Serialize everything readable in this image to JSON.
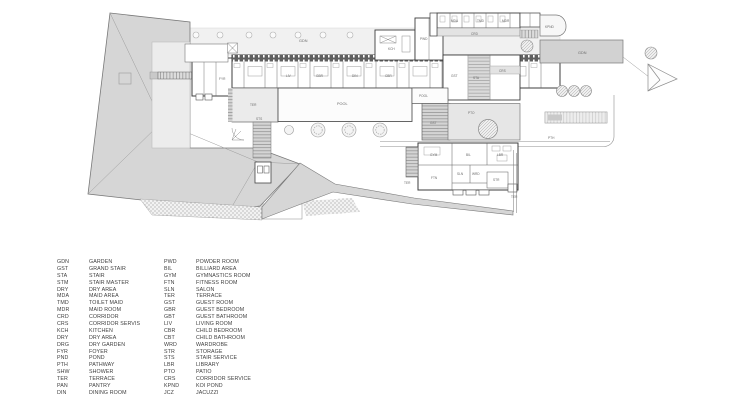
{
  "title": "residence-site-plan",
  "colors": {
    "wall": "#3d3d3d",
    "thin": "#8a8a8a",
    "roof": "#d6d6d6",
    "court": "#ececec",
    "strip": "#f1f1f1",
    "stair": "#d2d2d2",
    "patio": "#e6e6e6",
    "gdn": "#d2d2d2",
    "plantext": "#6b6b6b",
    "legendtext": "#3f3f3f"
  },
  "plan": {
    "labels": [
      {
        "t": "GDN",
        "x": 299,
        "y": 42,
        "s": "m"
      },
      {
        "t": "GDN",
        "x": 578,
        "y": 54,
        "s": "m"
      },
      {
        "t": "POOL",
        "x": 337,
        "y": 105,
        "s": "m"
      },
      {
        "t": "POOL",
        "x": 419,
        "y": 97,
        "s": "s"
      },
      {
        "t": "PTO",
        "x": 468,
        "y": 114,
        "s": "s"
      },
      {
        "t": "TER",
        "x": 250,
        "y": 106,
        "s": "s"
      },
      {
        "t": "GST",
        "x": 430,
        "y": 124,
        "s": "s"
      },
      {
        "t": "PTH",
        "x": 548,
        "y": 139,
        "s": "s"
      },
      {
        "t": "KPND",
        "x": 545,
        "y": 28,
        "s": "s"
      },
      {
        "t": "CRD",
        "x": 471,
        "y": 35,
        "s": "s"
      },
      {
        "t": "KCH",
        "x": 388,
        "y": 50,
        "s": "s"
      },
      {
        "t": "PWD",
        "x": 420,
        "y": 40,
        "s": "s"
      },
      {
        "t": "FYR",
        "x": 219,
        "y": 80,
        "s": "s"
      },
      {
        "t": "LIV",
        "x": 286,
        "y": 77,
        "s": "s"
      },
      {
        "t": "DIN",
        "x": 352,
        "y": 77,
        "s": "s"
      },
      {
        "t": "GBR",
        "x": 316,
        "y": 77,
        "s": "s"
      },
      {
        "t": "CBR",
        "x": 385,
        "y": 77,
        "s": "s"
      },
      {
        "t": "GST",
        "x": 451,
        "y": 77,
        "s": "s"
      },
      {
        "t": "GYM",
        "x": 430,
        "y": 156,
        "s": "s"
      },
      {
        "t": "BIL",
        "x": 466,
        "y": 156,
        "s": "s"
      },
      {
        "t": "LBR",
        "x": 497,
        "y": 156,
        "s": "s"
      },
      {
        "t": "FTN",
        "x": 431,
        "y": 179,
        "s": "s"
      },
      {
        "t": "SLN",
        "x": 457,
        "y": 175,
        "s": "s"
      },
      {
        "t": "WRD",
        "x": 472,
        "y": 175,
        "s": "s"
      },
      {
        "t": "STR",
        "x": 493,
        "y": 181,
        "s": "s"
      },
      {
        "t": "TER",
        "x": 404,
        "y": 184,
        "s": "s"
      },
      {
        "t": "TER",
        "x": 511,
        "y": 198,
        "s": "s"
      },
      {
        "t": "STS",
        "x": 256,
        "y": 120,
        "s": "s"
      },
      {
        "t": "STA",
        "x": 473,
        "y": 79,
        "s": "s"
      },
      {
        "t": "CRS",
        "x": 499,
        "y": 72,
        "s": "s"
      },
      {
        "t": "MDA",
        "x": 451,
        "y": 22,
        "s": "s"
      },
      {
        "t": "TMD",
        "x": 477,
        "y": 22,
        "s": "s"
      },
      {
        "t": "MDR",
        "x": 502,
        "y": 22,
        "s": "s"
      }
    ]
  },
  "legend": {
    "left": [
      {
        "code": "GDN",
        "label": "GARDEN"
      },
      {
        "code": "GST",
        "label": "GRAND STAIR"
      },
      {
        "code": "STA",
        "label": "STAIR"
      },
      {
        "code": "STM",
        "label": "STAIR MASTER"
      },
      {
        "code": "DRY",
        "label": "DRY AREA"
      },
      {
        "code": "MDA",
        "label": "MAID AREA"
      },
      {
        "code": "TMD",
        "label": "TOILET MAID"
      },
      {
        "code": "MDR",
        "label": "MAID ROOM"
      },
      {
        "code": "CRD",
        "label": "CORRIDOR"
      },
      {
        "code": "CRS",
        "label": "CORRIDOR SERVIS"
      },
      {
        "code": "KCH",
        "label": "KITCHEN"
      },
      {
        "code": "DRY",
        "label": "DRY AREA"
      },
      {
        "code": "DRG",
        "label": "DRY GARDEN"
      },
      {
        "code": "FYR",
        "label": "FOYER"
      },
      {
        "code": "PND",
        "label": "POND"
      },
      {
        "code": "PTH",
        "label": "PATHWAY"
      },
      {
        "code": "SHW",
        "label": "SHOWER"
      },
      {
        "code": "TER",
        "label": "TERRACE"
      },
      {
        "code": "PAN",
        "label": "PANTRY"
      },
      {
        "code": "DIN",
        "label": "DINING ROOM"
      }
    ],
    "right": [
      {
        "code": "PWD",
        "label": "POWDER ROOM"
      },
      {
        "code": "BIL",
        "label": "BILLIARD AREA"
      },
      {
        "code": "GYM",
        "label": "GYMNASTICS ROOM"
      },
      {
        "code": "FTN",
        "label": "FITNESS ROOM"
      },
      {
        "code": "SLN",
        "label": "SALON"
      },
      {
        "code": "TER",
        "label": "TERRACE"
      },
      {
        "code": "GST",
        "label": "GUEST ROOM"
      },
      {
        "code": "GBR",
        "label": "GUEST BEDROOM"
      },
      {
        "code": "GBT",
        "label": "GUEST BATHROOM"
      },
      {
        "code": "LIV",
        "label": "LIVING ROOM"
      },
      {
        "code": "CBR",
        "label": "CHILD BEDROOM"
      },
      {
        "code": "CBT",
        "label": "CHILD BATHROOM"
      },
      {
        "code": "WRD",
        "label": "WARDROBE"
      },
      {
        "code": "STR",
        "label": "STORAGE"
      },
      {
        "code": "STS",
        "label": "STAIR SERVICE"
      },
      {
        "code": "LBR",
        "label": "LIBRARY"
      },
      {
        "code": "PTO",
        "label": "PATIO"
      },
      {
        "code": "CRS",
        "label": "CORRIDOR SERVICE"
      },
      {
        "code": "KPND",
        "label": "KOI POND"
      },
      {
        "code": "JCZ",
        "label": "JACUZZI"
      }
    ]
  }
}
